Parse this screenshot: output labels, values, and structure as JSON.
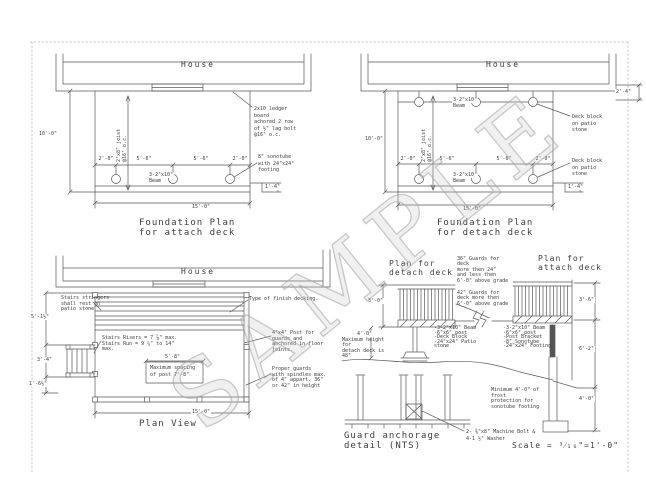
{
  "watermark": "SAMPLE",
  "attach_plan": {
    "house": "House",
    "title1": "Foundation Plan",
    "title2": "for attach deck",
    "dim_height": "10'-0\"",
    "dim_width": "15'-0\"",
    "dim_step": "1'-4\"",
    "post_dims": [
      "2'-0\"",
      "5'-6\"",
      "5'-6\"",
      "2'-0\""
    ],
    "joist1": "2\"x8\" joist",
    "joist2": "@16\" o.c.",
    "beam1": "3-2\"x10\"",
    "beam2": "Beam",
    "ledger_note": [
      "2x10 ledger",
      "board",
      "achored 2 row",
      "of ½\" lag bolt",
      "@16\" o.c."
    ],
    "sonotube_note": [
      "8\" sonotube",
      "with 24\"x24\"",
      "footing"
    ]
  },
  "detach_plan": {
    "house": "House",
    "title1": "Foundation Plan",
    "title2": "for detach deck",
    "dim_height": "10'-0\"",
    "dim_width": "15'-0\"",
    "dim_step": "1'-4\"",
    "dim_offset": "2'-4\"",
    "post_dims": [
      "2'-0\"",
      "5'-6\"",
      "5'-6\"",
      "2'-0\""
    ],
    "joist1": "2\"x8\" joist",
    "joist2": "@16\" o.c.",
    "beam_top1": "3-2\"x10\"",
    "beam_top2": "Beam",
    "beam_bot1": "3-2\"x10\"",
    "beam_bot2": "Beam",
    "block_note_top": [
      "Deck block",
      "on patio",
      "stone"
    ],
    "block_note_bot": [
      "Deck block",
      "on patio",
      "stone"
    ]
  },
  "plan_view": {
    "house": "House",
    "title": "Plan View",
    "dim_width": "15'-0\"",
    "dim_left": [
      "5'-1½\"",
      "3'-4\"",
      "1'-6½\""
    ],
    "stringer_note": [
      "Stairs stringers",
      "shall rest on",
      "patio stone"
    ],
    "risers_note": [
      "Stairs Risers = 7 ⅞\" max.",
      "Stairs Run = 9 ¼\" to 14\"",
      "max."
    ],
    "spacing_dim": "5'-8\"",
    "spacing_note": [
      "Maximum spacing",
      "of post 7'-8\""
    ],
    "decking_note": "Type of finish decking.",
    "post_note": [
      "4\"x4\" Post for",
      "guards and",
      "anchored in floor",
      "joints."
    ],
    "guard_note": [
      "Proper guards",
      "with spindles max.",
      "of 4\" appart. 36\"",
      "or 42\" in height"
    ]
  },
  "elevation": {
    "detach_title1": "Plan for",
    "detach_title2": "detach deck",
    "attach_title1": "Plan for",
    "attach_title2": "attach deck",
    "guard36_note": [
      "36\" Guards for",
      "deck",
      "more then 24\"",
      "and less then",
      "6'-0\" above grade"
    ],
    "guard42_note": [
      "42\" Guards for",
      "deck more then",
      "6'-0\" above grade"
    ],
    "dim_rail": "3'-0\"",
    "dim_height": "4'-0\"",
    "height_note": [
      "Maximum height",
      "for",
      "detach deck is",
      "48\""
    ],
    "detach_parts": [
      "-3-2\"x10\" Beam",
      "-6\"x6\" post",
      "-Deck Block",
      "-24\"x24\" Patio",
      "stone"
    ],
    "attach_parts": [
      "-3-2\"x10\" Beam",
      "-6\"x6\" post",
      "-Post Bracket",
      "-8\" Sonotube",
      "-24\"x24\" Footing"
    ],
    "dim_rail_r": "3'-6\"",
    "dim_mid_r": "6'-2\"",
    "dim_frost_r": "4'-0\"",
    "frost_note": [
      "Minimum 4'-0\" of",
      "frost",
      "protection for",
      "sonotube footing"
    ],
    "anchor_title1": "Guard anchorage",
    "anchor_title2": "detail (NTS)",
    "bolt_note": [
      "2- ⅜\"x8\" Machine Bolt &",
      "4-1 ½\" Washer"
    ],
    "scale": "Scale = ³⁄₁₆\"=1'-0\""
  }
}
